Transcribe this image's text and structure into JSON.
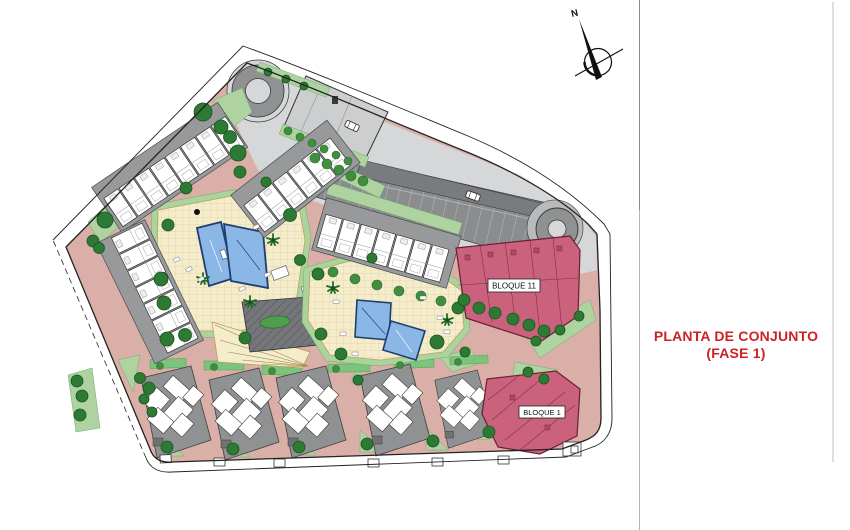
{
  "panel": {
    "title_line1": "PLANTA DE CONJUNTO",
    "title_line2": "(FASE 1)",
    "title_color": "#cc2127"
  },
  "plan": {
    "compass_label": "N",
    "labels": {
      "bloque_11": "BLOQUE 11",
      "bloque_1": "BLOQUE 1"
    },
    "colors": {
      "ground_road": "#d9afa7",
      "pavement": "#d6d7d8",
      "parking": "#8a8c8e",
      "roof_gray": "#96989a",
      "landscape_green": "#aed3a0",
      "tree_green": "#2c7a33",
      "pool_blue": "#8ab7e6",
      "deck_cream": "#f4eccb",
      "bloque_pink": "#ca617d"
    }
  }
}
